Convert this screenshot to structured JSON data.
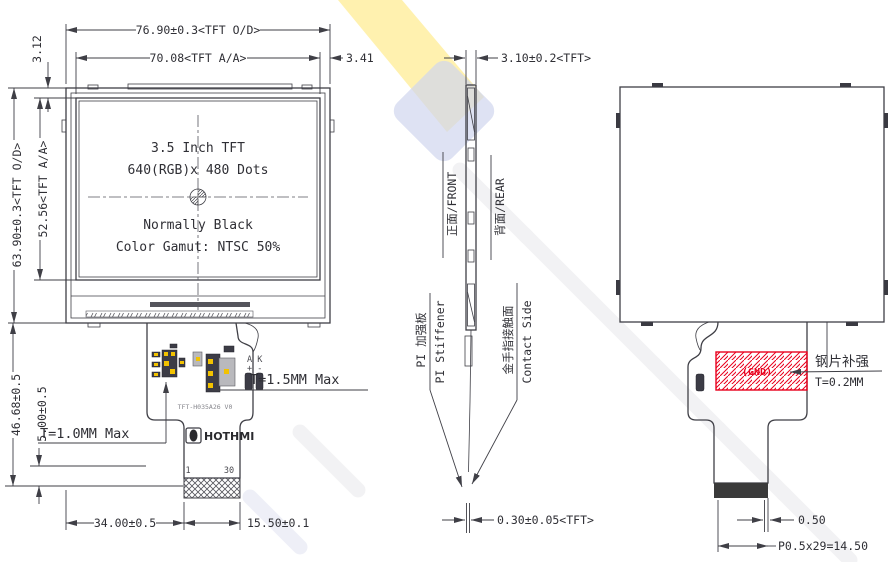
{
  "drawing": {
    "front": {
      "dim_width_od": "76.90±0.3<TFT O/D>",
      "dim_width_aa": "70.08<TFT A/A>",
      "dim_right_gap": "3.41",
      "dim_top_gap": "3.12",
      "dim_height_od": "63.90±0.3<TFT O/D>",
      "dim_height_aa": "52.56<TFT A/A>",
      "spec_line1": "3.5 Inch TFT",
      "spec_line2": "640(RGB)x 480 Dots",
      "spec_line3": "Normally Black",
      "spec_line4": "Color Gamut: NTSC 50%",
      "dim_fpc_drop": "46.68±0.5",
      "dim_contact_len": "5.00±0.5",
      "note_t15": "T=1.5MM Max",
      "note_t10": "T=1.0MM Max",
      "part_number": "TFT-H035A26 V0",
      "brand": "HOTHMI",
      "pin_first": "1",
      "pin_last": "30",
      "led_pins": "A K",
      "led_polarity": "+ -",
      "dim_fpc_width": "34.00±0.5",
      "dim_tail_width": "15.50±0.1"
    },
    "side": {
      "dim_thickness": "3.10±0.2<TFT>",
      "label_front": "正面/FRONT",
      "label_rear": "背面/REAR",
      "label_stiffener_cn": "PI 加强板",
      "label_stiffener_en": "PI Stiffener",
      "label_contact_cn": "金手指接触面",
      "label_contact_en": "Contact Side",
      "dim_fpc_thickness": "0.30±0.05<TFT>"
    },
    "rear": {
      "label_gnd": "(GND)",
      "label_steel_cn": "钢片补强",
      "label_steel_t": "T=0.2MM",
      "dim_pin_width": "0.50",
      "dim_pitch": "P0.5x29=14.50"
    },
    "colors": {
      "line": "#3f3f46",
      "red": "#e8001d",
      "yellow": "#f2c200"
    }
  }
}
